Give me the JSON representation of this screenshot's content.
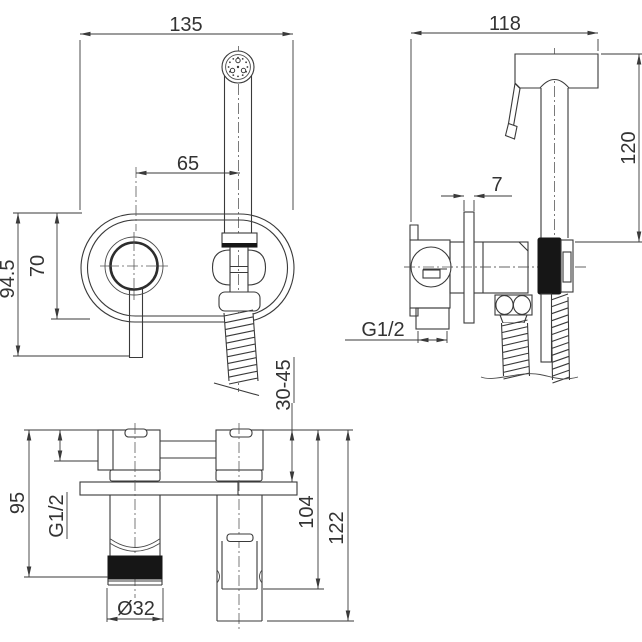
{
  "drawing": {
    "background": "#ffffff",
    "line_color": "#3a3a3a",
    "black_fill": "#161616",
    "views": {
      "front": {
        "name": "front-view",
        "dims": {
          "overall_width": "135",
          "center_distance": "65",
          "overall_height": "94.5",
          "plate_height": "70",
          "install_depth_range": "30-45"
        }
      },
      "side": {
        "name": "side-view",
        "dims": {
          "overall_width": "118",
          "sprayer_height": "120",
          "plate_thickness": "7",
          "inlet_thread": "G1/2"
        }
      },
      "bottom": {
        "name": "bottom-view",
        "dims": {
          "body_height": "95",
          "inlet_thread": "G1/2",
          "knob_projection": "104",
          "lever_projection": "122",
          "sprayer_diameter": "Ø32"
        }
      }
    }
  }
}
